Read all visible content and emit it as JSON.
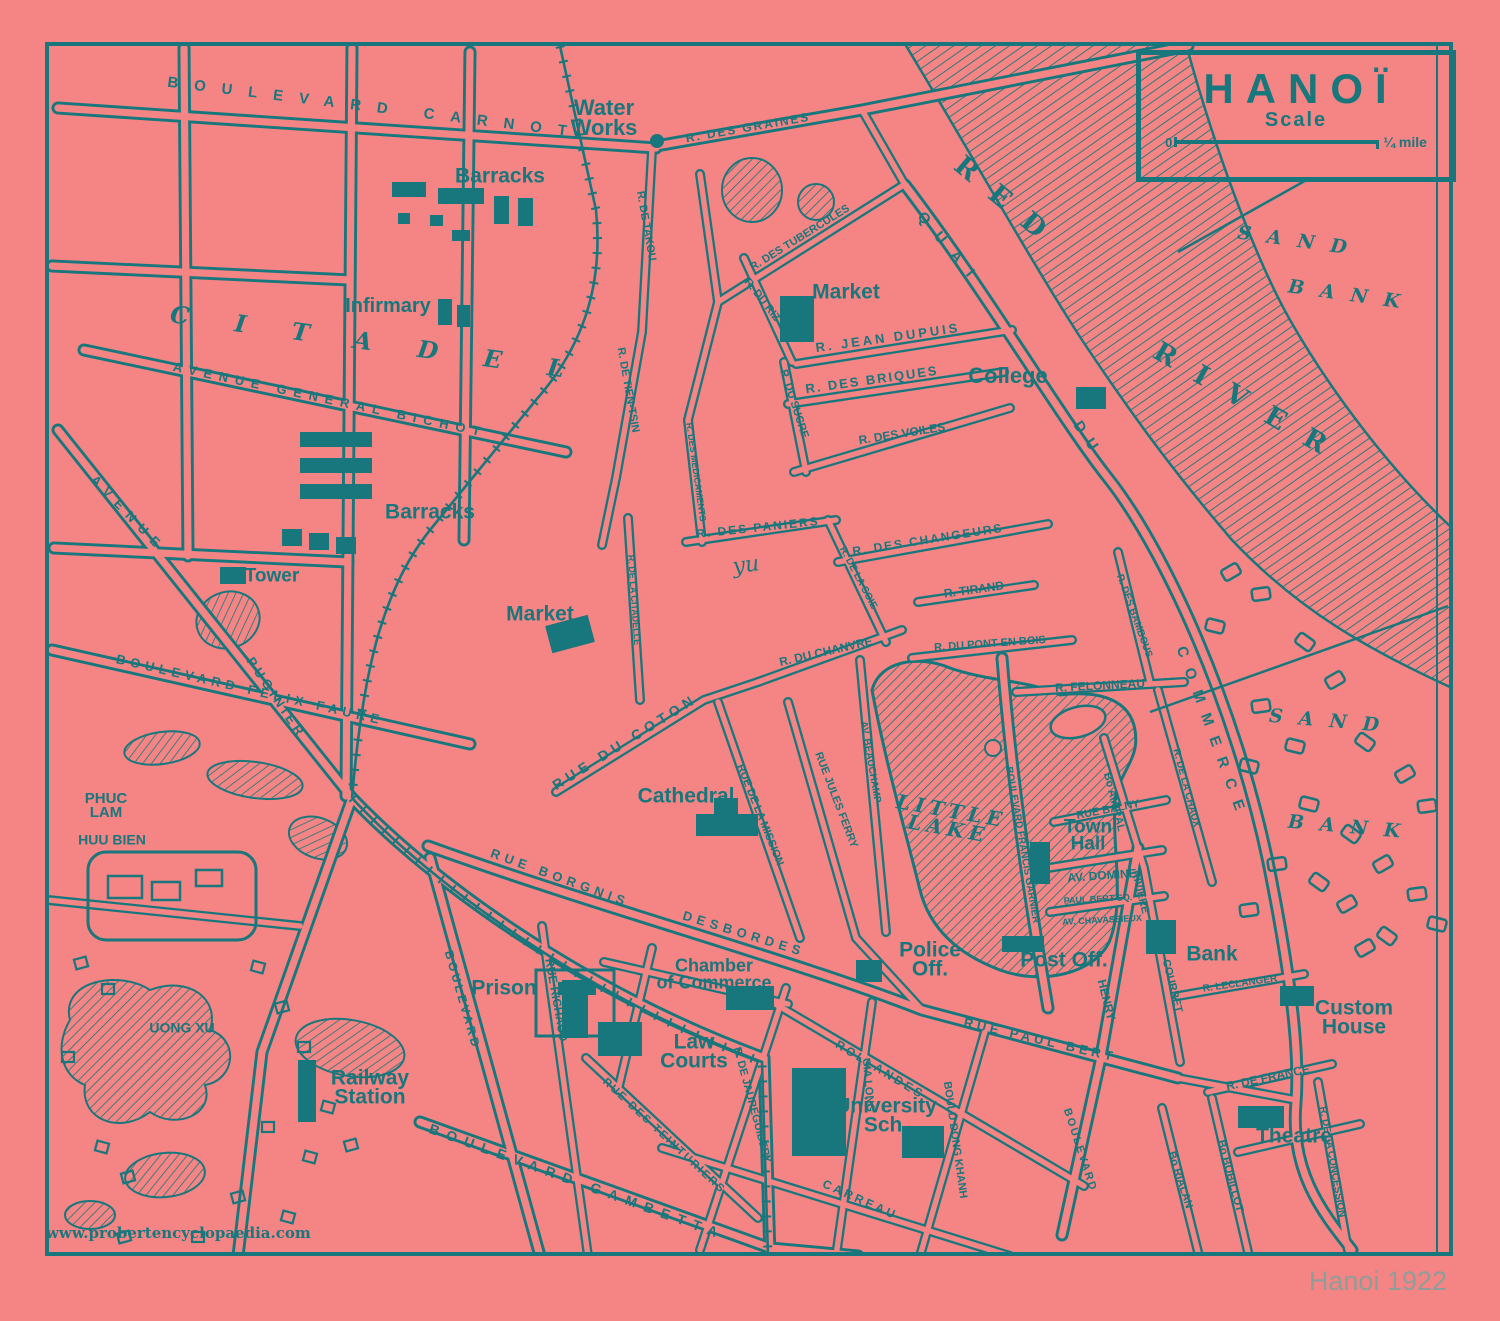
{
  "title_box": {
    "title": "HANOÏ",
    "scale_label": "Scale",
    "zero": "0",
    "unit": "¼ mile"
  },
  "watermark": "www.probertencyclopaedia.com",
  "caption": "Hanoi 1922",
  "colors": {
    "background": "#f48584",
    "ink": "#18777d",
    "caption": "#8d9e9a"
  },
  "labels": [
    {
      "t": "BOULEVARD CARNOT",
      "x": 375,
      "y": 108,
      "r": 7,
      "s": 15,
      "ls": 16,
      "c": "street-lg"
    },
    {
      "t": "Water\nWorks",
      "x": 604,
      "y": 118,
      "r": 0,
      "s": 22,
      "c": "place"
    },
    {
      "t": "R. DES GRAINES",
      "x": 748,
      "y": 128,
      "r": -10,
      "s": 12,
      "ls": 2,
      "c": "street"
    },
    {
      "t": "Barracks",
      "x": 500,
      "y": 176,
      "r": 0,
      "s": 21,
      "c": "place"
    },
    {
      "t": "Infirmary",
      "x": 388,
      "y": 306,
      "r": 0,
      "s": 20,
      "c": "place"
    },
    {
      "t": "Barracks",
      "x": 430,
      "y": 512,
      "r": 0,
      "s": 21,
      "c": "place"
    },
    {
      "t": "Tower",
      "x": 272,
      "y": 576,
      "r": 0,
      "s": 19,
      "c": "place"
    },
    {
      "t": "CITADEL",
      "x": 390,
      "y": 345,
      "r": 8,
      "s": 24,
      "ls": 46,
      "c": "area"
    },
    {
      "t": "AVENUE GENERAL BICHOT",
      "x": 330,
      "y": 400,
      "r": 12,
      "s": 13,
      "ls": 7,
      "c": "street-lg"
    },
    {
      "t": "AVENUE",
      "x": 128,
      "y": 514,
      "r": 46,
      "s": 13,
      "ls": 8,
      "c": "street-lg"
    },
    {
      "t": "PUGINIER",
      "x": 276,
      "y": 698,
      "r": 56,
      "s": 13,
      "ls": 4,
      "c": "street"
    },
    {
      "t": "BOULEVARD FELIX FAURE",
      "x": 250,
      "y": 690,
      "r": 13,
      "s": 13,
      "ls": 5,
      "c": "street-lg"
    },
    {
      "t": "R. DE TAKOU",
      "x": 646,
      "y": 226,
      "r": 80,
      "s": 11,
      "c": "street"
    },
    {
      "t": "R. DE TIEN-TSIN",
      "x": 628,
      "y": 390,
      "r": 80,
      "s": 11,
      "c": "street"
    },
    {
      "t": "R. DES TUBERCULES",
      "x": 800,
      "y": 238,
      "r": -32,
      "s": 11,
      "c": "street"
    },
    {
      "t": "Market",
      "x": 846,
      "y": 292,
      "r": 0,
      "s": 21,
      "c": "place"
    },
    {
      "t": "R. JEAN DUPUIS",
      "x": 888,
      "y": 338,
      "r": -8,
      "s": 13,
      "ls": 3,
      "c": "street"
    },
    {
      "t": "R. DES BRIQUES",
      "x": 872,
      "y": 380,
      "r": -8,
      "s": 13,
      "ls": 2,
      "c": "street"
    },
    {
      "t": "College",
      "x": 1008,
      "y": 376,
      "r": 0,
      "s": 22,
      "c": "place"
    },
    {
      "t": "R. DU RIZ",
      "x": 762,
      "y": 300,
      "r": 52,
      "s": 11,
      "c": "street"
    },
    {
      "t": "R. DU SUCRE",
      "x": 794,
      "y": 404,
      "r": 72,
      "s": 11,
      "c": "street"
    },
    {
      "t": "R. DES VOILES",
      "x": 902,
      "y": 434,
      "r": -9,
      "s": 12,
      "c": "street"
    },
    {
      "t": "R. DES MEDICAMENTS",
      "x": 696,
      "y": 472,
      "r": 82,
      "s": 9,
      "c": "street"
    },
    {
      "t": "R. DES PANIERS",
      "x": 758,
      "y": 528,
      "r": -6,
      "s": 12,
      "ls": 2,
      "c": "street"
    },
    {
      "t": "R. DE LA CITADELLE",
      "x": 634,
      "y": 600,
      "r": 86,
      "s": 9,
      "c": "street"
    },
    {
      "t": "R. DE LA SOIE",
      "x": 858,
      "y": 578,
      "r": 62,
      "s": 10,
      "c": "street"
    },
    {
      "t": "R. DES CHANGEURS",
      "x": 928,
      "y": 540,
      "r": -9,
      "s": 12,
      "ls": 2,
      "c": "street"
    },
    {
      "t": "R. TIRAND",
      "x": 974,
      "y": 590,
      "r": -8,
      "s": 12,
      "c": "street"
    },
    {
      "t": "R. DU PONT EN BOIS",
      "x": 990,
      "y": 644,
      "r": -4,
      "s": 11,
      "c": "street"
    },
    {
      "t": "R. FELONNEAU",
      "x": 1100,
      "y": 686,
      "r": -3,
      "s": 12,
      "c": "street"
    },
    {
      "t": "R. DU CHANVRE",
      "x": 826,
      "y": 652,
      "r": -13,
      "s": 12,
      "c": "street"
    },
    {
      "t": "Market",
      "x": 540,
      "y": 614,
      "r": 0,
      "s": 21,
      "c": "place"
    },
    {
      "t": "RUE DU COTON",
      "x": 625,
      "y": 742,
      "r": -32,
      "s": 14,
      "ls": 5,
      "c": "street-lg"
    },
    {
      "t": "yu",
      "x": 746,
      "y": 566,
      "r": -8,
      "s": 22,
      "c": "scriptish"
    },
    {
      "t": "QUAI",
      "x": 950,
      "y": 250,
      "r": 50,
      "s": 15,
      "ls": 14,
      "c": "street-lg"
    },
    {
      "t": "DU",
      "x": 1088,
      "y": 440,
      "r": 56,
      "s": 15,
      "ls": 10,
      "c": "street-lg"
    },
    {
      "t": "COMMERCE",
      "x": 1212,
      "y": 734,
      "r": 70,
      "s": 15,
      "ls": 12,
      "c": "street-lg"
    },
    {
      "t": "RED",
      "x": 1008,
      "y": 205,
      "r": 40,
      "s": 27,
      "ls": 22,
      "c": "river"
    },
    {
      "t": "RIVER",
      "x": 1250,
      "y": 405,
      "r": 30,
      "s": 27,
      "ls": 24,
      "c": "river"
    },
    {
      "t": "SAND",
      "x": 1300,
      "y": 242,
      "r": 8,
      "s": 19,
      "ls": 16,
      "c": "area"
    },
    {
      "t": "BANK",
      "x": 1352,
      "y": 296,
      "r": 8,
      "s": 19,
      "ls": 16,
      "c": "area"
    },
    {
      "t": "SAND",
      "x": 1332,
      "y": 722,
      "r": 5,
      "s": 19,
      "ls": 16,
      "c": "area"
    },
    {
      "t": "BANK",
      "x": 1352,
      "y": 828,
      "r": 5,
      "s": 19,
      "ls": 16,
      "c": "area"
    },
    {
      "t": "PHUC\nLAM",
      "x": 106,
      "y": 806,
      "r": 0,
      "s": 15,
      "c": "street"
    },
    {
      "t": "HUU BIEN",
      "x": 112,
      "y": 840,
      "r": 0,
      "s": 14,
      "c": "street"
    },
    {
      "t": "UONG XU",
      "x": 182,
      "y": 1028,
      "r": 0,
      "s": 14,
      "c": "street"
    },
    {
      "t": "Railway\nStation",
      "x": 370,
      "y": 1088,
      "r": 0,
      "s": 21,
      "c": "place"
    },
    {
      "t": "Prison",
      "x": 504,
      "y": 988,
      "r": 0,
      "s": 21,
      "c": "place"
    },
    {
      "t": "BOULEVARD",
      "x": 462,
      "y": 1000,
      "r": 74,
      "s": 12,
      "ls": 3,
      "c": "street"
    },
    {
      "t": "RUE RICHAUD",
      "x": 556,
      "y": 1000,
      "r": 80,
      "s": 12,
      "c": "street"
    },
    {
      "t": "RUE BORGNIS",
      "x": 560,
      "y": 878,
      "r": 20,
      "s": 13,
      "ls": 5,
      "c": "street-lg"
    },
    {
      "t": "DESBORDES",
      "x": 744,
      "y": 934,
      "r": 17,
      "s": 13,
      "ls": 5,
      "c": "street-lg"
    },
    {
      "t": "RUE DES TEINTURIERS",
      "x": 664,
      "y": 1136,
      "r": 43,
      "s": 11,
      "ls": 2,
      "c": "street"
    },
    {
      "t": "BOULEVARD GAMBETTA",
      "x": 577,
      "y": 1182,
      "r": 20,
      "s": 14,
      "ls": 8,
      "c": "street-lg"
    },
    {
      "t": "Chamber\nof Commerce",
      "x": 714,
      "y": 974,
      "r": 0,
      "s": 18,
      "c": "place"
    },
    {
      "t": "Law\nCourts",
      "x": 694,
      "y": 1052,
      "r": 0,
      "s": 21,
      "c": "place"
    },
    {
      "t": "Cathedral",
      "x": 686,
      "y": 796,
      "r": 0,
      "s": 21,
      "c": "place"
    },
    {
      "t": "RUE DE LA MISSION",
      "x": 760,
      "y": 815,
      "r": 68,
      "s": 11,
      "c": "street"
    },
    {
      "t": "RUE JULES FERRY",
      "x": 836,
      "y": 800,
      "r": 69,
      "s": 11,
      "c": "street"
    },
    {
      "t": "AV. BEAUCHAMP",
      "x": 870,
      "y": 762,
      "r": 80,
      "s": 10,
      "c": "street"
    },
    {
      "t": "LITTLE\nLAKE",
      "x": 950,
      "y": 820,
      "r": 10,
      "s": 20,
      "ls": 5,
      "c": "lake"
    },
    {
      "t": "Police\nOff.",
      "x": 930,
      "y": 960,
      "r": 0,
      "s": 21,
      "c": "place"
    },
    {
      "t": "BOULEVARD FRANCIS GARNIER",
      "x": 1022,
      "y": 845,
      "r": 80,
      "s": 10,
      "c": "street"
    },
    {
      "t": "Town\nHall",
      "x": 1088,
      "y": 836,
      "r": 0,
      "s": 19,
      "c": "place"
    },
    {
      "t": "RUE BALNY",
      "x": 1108,
      "y": 810,
      "r": -11,
      "s": 11,
      "c": "street"
    },
    {
      "t": "AV. DOMINE",
      "x": 1102,
      "y": 876,
      "r": -4,
      "s": 12,
      "c": "street"
    },
    {
      "t": "PAUL BERT SQ.",
      "x": 1098,
      "y": 899,
      "r": -3,
      "s": 9,
      "c": "street"
    },
    {
      "t": "AV. CHAVASSIEUX",
      "x": 1102,
      "y": 920,
      "r": -3,
      "s": 9,
      "c": "street"
    },
    {
      "t": "Post Off.",
      "x": 1064,
      "y": 960,
      "r": 0,
      "s": 21,
      "c": "place"
    },
    {
      "t": "RIVIERE",
      "x": 1140,
      "y": 892,
      "r": 76,
      "s": 11,
      "c": "street"
    },
    {
      "t": "HENRY",
      "x": 1106,
      "y": 1000,
      "r": 76,
      "s": 12,
      "c": "street"
    },
    {
      "t": "BOULEVARD",
      "x": 1080,
      "y": 1150,
      "r": 72,
      "s": 11,
      "ls": 2,
      "c": "street"
    },
    {
      "t": "Bo AMIRAL",
      "x": 1114,
      "y": 802,
      "r": 76,
      "s": 11,
      "c": "street"
    },
    {
      "t": "COURBET",
      "x": 1172,
      "y": 986,
      "r": 76,
      "s": 11,
      "c": "street"
    },
    {
      "t": "R. DES BAMBOUS",
      "x": 1134,
      "y": 616,
      "r": 70,
      "s": 10,
      "c": "street"
    },
    {
      "t": "R. DE LA CHAUX",
      "x": 1186,
      "y": 788,
      "r": 75,
      "s": 10,
      "c": "street"
    },
    {
      "t": "Bank",
      "x": 1212,
      "y": 954,
      "r": 0,
      "s": 21,
      "c": "place"
    },
    {
      "t": "R. LECLANGER",
      "x": 1240,
      "y": 984,
      "r": -8,
      "s": 10,
      "c": "street"
    },
    {
      "t": "Custom\nHouse",
      "x": 1354,
      "y": 1018,
      "r": 0,
      "s": 21,
      "c": "place"
    },
    {
      "t": "R. DE FRANCE",
      "x": 1268,
      "y": 1078,
      "r": -12,
      "s": 12,
      "c": "street"
    },
    {
      "t": "Theatre",
      "x": 1294,
      "y": 1136,
      "r": 0,
      "s": 21,
      "c": "place"
    },
    {
      "t": "RUE PAUL BERT",
      "x": 1040,
      "y": 1040,
      "r": 13,
      "s": 13,
      "ls": 4,
      "c": "street-lg"
    },
    {
      "t": "BOULD DONG KHANH",
      "x": 955,
      "y": 1140,
      "r": 82,
      "s": 11,
      "c": "street"
    },
    {
      "t": "ROLLANDES",
      "x": 880,
      "y": 1070,
      "r": 31,
      "s": 12,
      "ls": 3,
      "c": "street"
    },
    {
      "t": "GIA LONG",
      "x": 868,
      "y": 1085,
      "r": 85,
      "s": 11,
      "c": "street"
    },
    {
      "t": "R. DE JAUREGUIBERY",
      "x": 752,
      "y": 1105,
      "r": 75,
      "s": 11,
      "c": "street"
    },
    {
      "t": "CARREAU",
      "x": 860,
      "y": 1200,
      "r": 24,
      "s": 12,
      "ls": 3,
      "c": "street"
    },
    {
      "t": "Bo RIALAN",
      "x": 1180,
      "y": 1180,
      "r": 72,
      "s": 11,
      "c": "street"
    },
    {
      "t": "Bo BOBILLOT",
      "x": 1230,
      "y": 1176,
      "r": 75,
      "s": 11,
      "c": "street"
    },
    {
      "t": "R. DE LA CONCESSION",
      "x": 1332,
      "y": 1162,
      "r": 80,
      "s": 10,
      "c": "street"
    },
    {
      "t": "University\nSch.",
      "x": 886,
      "y": 1116,
      "r": 0,
      "s": 21,
      "c": "place"
    }
  ]
}
